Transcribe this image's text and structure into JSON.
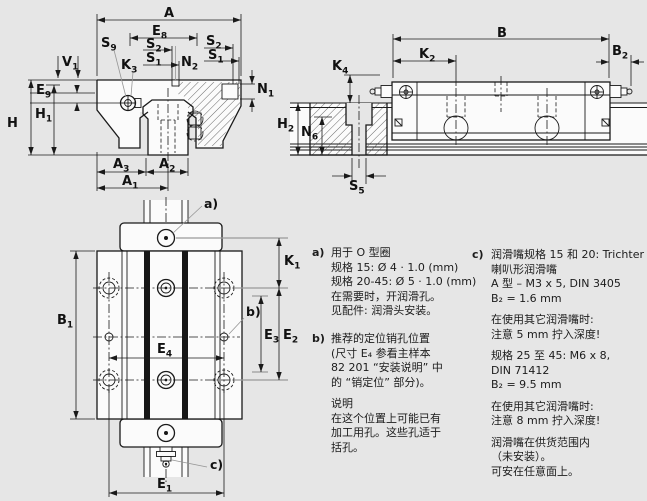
{
  "callouts": {
    "a": "a)",
    "b": "b)",
    "c": "c)"
  },
  "dims": {
    "A": {
      "m": "A",
      "s": ""
    },
    "E8": {
      "m": "E",
      "s": "8"
    },
    "S2": {
      "m": "S",
      "s": "2"
    },
    "S1": {
      "m": "S",
      "s": "1"
    },
    "S9": {
      "m": "S",
      "s": "9"
    },
    "K3": {
      "m": "K",
      "s": "3"
    },
    "N2": {
      "m": "N",
      "s": "2"
    },
    "N1": {
      "m": "N",
      "s": "1"
    },
    "V1": {
      "m": "V",
      "s": "1"
    },
    "E9": {
      "m": "E",
      "s": "9"
    },
    "H1": {
      "m": "H",
      "s": "1"
    },
    "H": {
      "m": "H",
      "s": ""
    },
    "A3": {
      "m": "A",
      "s": "3"
    },
    "A2": {
      "m": "A",
      "s": "2"
    },
    "A1": {
      "m": "A",
      "s": "1"
    },
    "B": {
      "m": "B",
      "s": ""
    },
    "K2": {
      "m": "K",
      "s": "2"
    },
    "B2": {
      "m": "B",
      "s": "2"
    },
    "K4": {
      "m": "K",
      "s": "4"
    },
    "H2": {
      "m": "H",
      "s": "2"
    },
    "N6": {
      "m": "N",
      "s": "6"
    },
    "S5": {
      "m": "S",
      "s": "5"
    },
    "K1": {
      "m": "K",
      "s": "1"
    },
    "B1": {
      "m": "B",
      "s": "1"
    },
    "E3": {
      "m": "E",
      "s": "3"
    },
    "E2": {
      "m": "E",
      "s": "2"
    },
    "E4": {
      "m": "E",
      "s": "4"
    },
    "E1": {
      "m": "E",
      "s": "1"
    }
  },
  "notes": {
    "a": {
      "tag": "a)",
      "lines": [
        "用于 O 型圈",
        "规格 15: Ø 4 · 1.0 (mm)",
        "规格 20-45: Ø 5 · 1.0 (mm)",
        "在需要时，开润滑孔。",
        "见配件: 润滑头安装。"
      ]
    },
    "b": {
      "tag": "b)",
      "lines": [
        "推荐的定位销孔位置",
        "(尺寸 E₄ 参看主样本",
        "82 201 “安装说明” 中",
        "的 “销定位” 部分)。"
      ]
    },
    "b_note": {
      "lines": [
        "说明",
        "在这个位置上可能已有",
        "加工用孔。这些孔适于",
        "括孔。"
      ]
    },
    "c": {
      "tag": "c)",
      "paragraphs": [
        [
          "润滑嘴规格 15 和 20: Trichter",
          "喇叭形润滑嘴",
          "A 型 – M3 x 5, DIN 3405",
          "B₂ = 1.6 mm"
        ],
        [
          "在使用其它润滑嘴时:",
          "注意 5 mm 拧入深度!"
        ],
        [
          "规格 25 至 45: M6 x 8,",
          "DIN 71412",
          "B₂ = 9.5 mm"
        ],
        [
          "在使用其它润滑嘴时:",
          "注意 8 mm 拧入深度!"
        ],
        [
          "润滑嘴在供货范围内",
          "（未安装）。",
          "可安在任意面上。"
        ]
      ]
    }
  },
  "colors": {
    "background": "#e6e6e6",
    "part_fill": "#fbfbfb",
    "line": "#1a1a1a",
    "leader": "#969696"
  }
}
